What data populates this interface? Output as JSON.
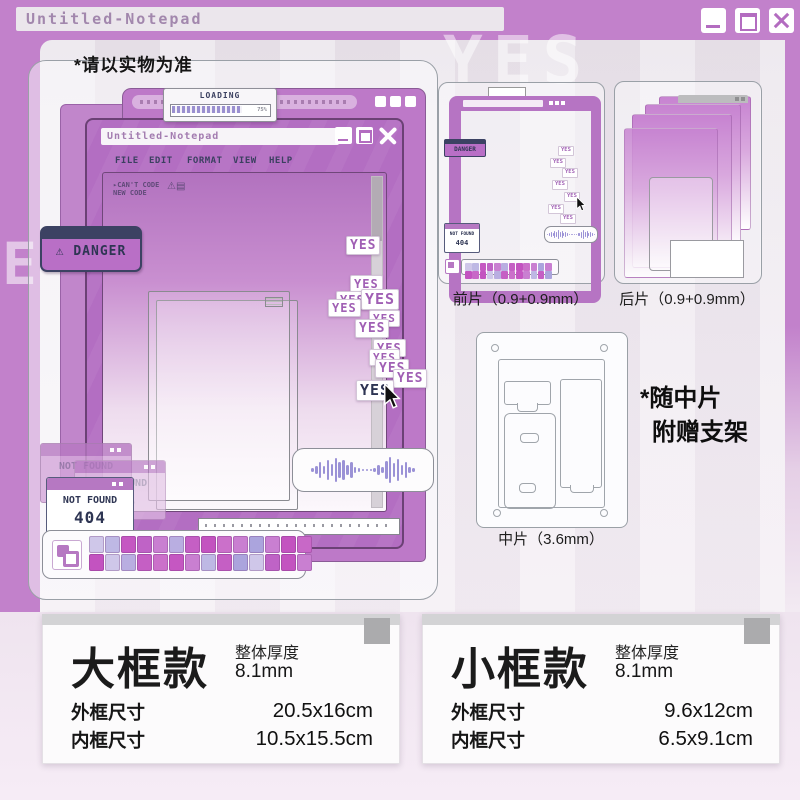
{
  "window": {
    "title": "Untitled-Notepad"
  },
  "disclaimer": "*请以实物为准",
  "ghost": {
    "word": "YES",
    "letter": "E"
  },
  "product": {
    "loading": {
      "label": "LOADING",
      "percent": "75%"
    },
    "notepad": {
      "title": "Untitled-Notepad",
      "menu": [
        "FILE",
        "EDIT",
        "FORMAT",
        "VIEW",
        "HELP"
      ],
      "console_line1": "▸CAN'T CODE",
      "console_line2": "NEW CODE",
      "console_icons": "⚠▤"
    },
    "danger": {
      "icon": "⚠",
      "label": "DANGER"
    },
    "yes_label": "YES",
    "not_found": {
      "title": "NOT FOUND",
      "code": "404"
    }
  },
  "pieces": {
    "front_label": "前片（0.9+0.9mm）",
    "back_label": "后片（0.9+0.9mm）",
    "middle_label": "中片（3.6mm）",
    "middle_note1": "*随中片",
    "middle_note2": "附赠支架"
  },
  "specs": [
    {
      "name": "大框款",
      "thickness_label": "整体厚度",
      "thickness_value": "8.1mm",
      "rows": [
        {
          "label": "外框尺寸",
          "value": "20.5x16cm"
        },
        {
          "label": "内框尺寸",
          "value": "10.5x15.5cm"
        }
      ]
    },
    {
      "name": "小框款",
      "thickness_label": "整体厚度",
      "thickness_value": "8.1mm",
      "rows": [
        {
          "label": "外框尺寸",
          "value": "9.6x12cm"
        },
        {
          "label": "内框尺寸",
          "value": "6.5x9.1cm"
        }
      ]
    }
  ],
  "palette": [
    "#cfc7e9",
    "#beb8e4",
    "#c557c2",
    "#bf63c6",
    "#c97fd1",
    "#b9aee1",
    "#c55fc4",
    "#c353c0",
    "#cb70ca",
    "#c97fd1",
    "#aba4dd",
    "#c97fd1",
    "#c353c0",
    "#c868c7",
    "#c353c0",
    "#cfc7e9",
    "#b9aee1",
    "#c55fc4",
    "#cb70ca",
    "#c557c2",
    "#c97fd1",
    "#beb8e4",
    "#c55fc4",
    "#aba4dd",
    "#cfc7e9",
    "#bf63c6",
    "#c353c0",
    "#c97fd1"
  ],
  "colors": {
    "chrome": "#c281cb",
    "window_purple": "#b36ec2",
    "navy": "#3b4060",
    "sticker_text": "#a05fb4"
  }
}
